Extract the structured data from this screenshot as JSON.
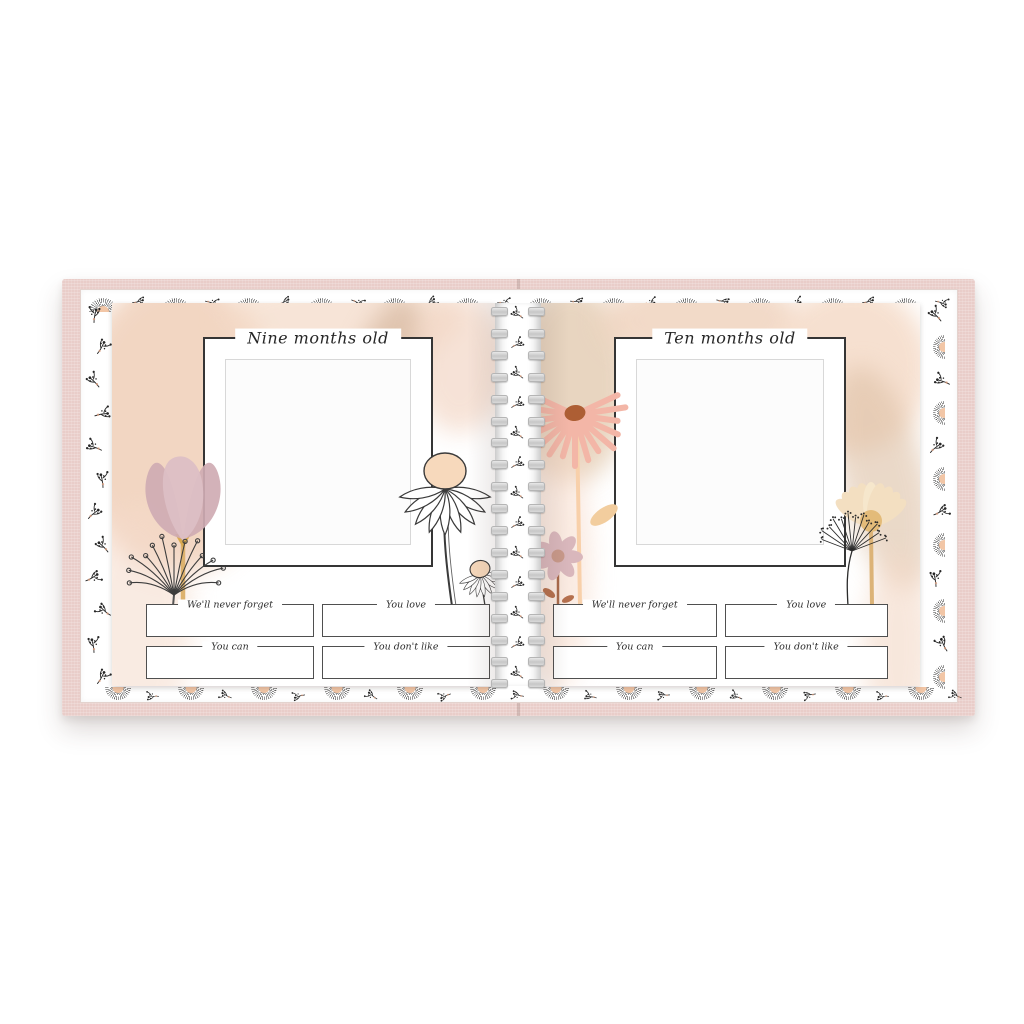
{
  "product": {
    "type": "Open spiral-bound baby memory book spread on white background",
    "left_page": {
      "title": "Nine months old",
      "fields": [
        "We'll never forget",
        "You love",
        "You can",
        "You don't like"
      ]
    },
    "right_page": {
      "title": "Ten months old",
      "fields": [
        "We'll never forget",
        "You love",
        "You can",
        "You don't like"
      ]
    },
    "decor_motifs": [
      "fan-flower",
      "floral-sprig",
      "tulip",
      "seed-head",
      "coneflower",
      "pink-coneflower",
      "daisy",
      "cream-daisy",
      "queen-annes-lace",
      "watercolor-wash",
      "wire-o-binding"
    ],
    "colors": {
      "background": "#ffffff",
      "cover_pink": "#e9cdc9",
      "page_white": "#ffffff",
      "watercolor_peach": "#f0ceb6",
      "watercolor_tan": "#d8bba3",
      "petal_mauve": "#d6b5bb",
      "petal_pink": "#f3b6a7",
      "terracotta": "#ad5e34",
      "cream_petal": "#f3dfc1",
      "stem_gold": "#ddb26e",
      "ink": "#333333",
      "fan_center_peach": "#f2c6a6",
      "binding_gray": "#d6d6d6"
    }
  }
}
